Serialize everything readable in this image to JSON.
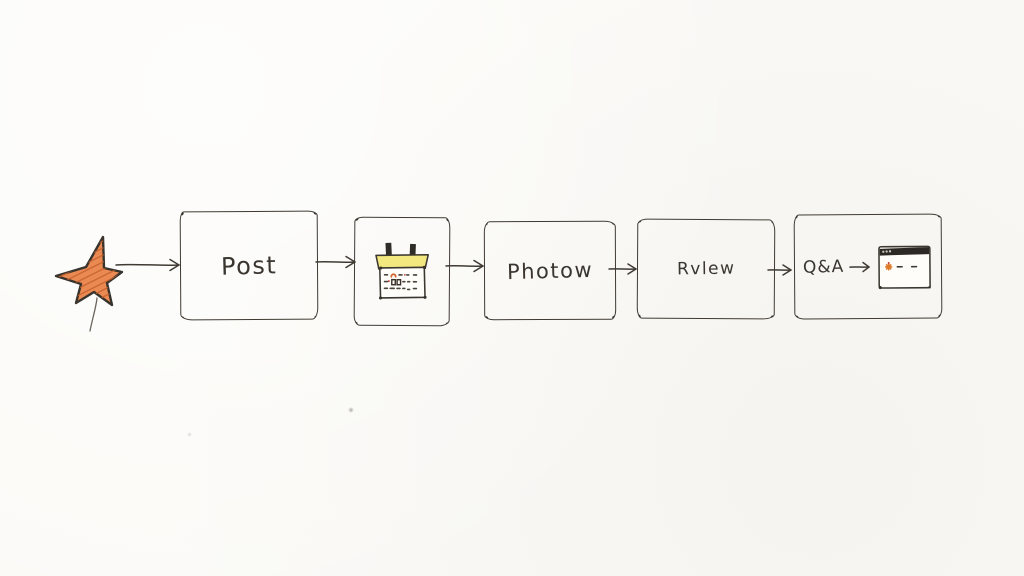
{
  "canvas": {
    "type": "hand-drawn-flowchart",
    "paper_color": "#fbfaf7",
    "ink_color": "#403a33"
  },
  "flow": {
    "nodes": [
      {
        "id": "start",
        "kind": "icon",
        "icon": "star-icon",
        "icon_color": "#e8854d",
        "label": ""
      },
      {
        "id": "post",
        "kind": "box",
        "label": "Post"
      },
      {
        "id": "schedule",
        "kind": "box",
        "icon": "calendar-icon",
        "icon_color": "#f2e87f",
        "label": ""
      },
      {
        "id": "photos",
        "kind": "box",
        "label": "Photow"
      },
      {
        "id": "review",
        "kind": "box",
        "label": "Rvlew"
      },
      {
        "id": "qa",
        "kind": "box",
        "label": "Q&A",
        "icon": "browser-window-icon",
        "icon_color": "#2c2824",
        "icon_accent": "#dd7a2b"
      }
    ],
    "connections": [
      {
        "from": "start",
        "to": "post"
      },
      {
        "from": "post",
        "to": "schedule"
      },
      {
        "from": "schedule",
        "to": "photos"
      },
      {
        "from": "photos",
        "to": "review"
      },
      {
        "from": "review",
        "to": "qa"
      },
      {
        "from": "qa-label",
        "to": "qa-browser-icon"
      }
    ]
  }
}
